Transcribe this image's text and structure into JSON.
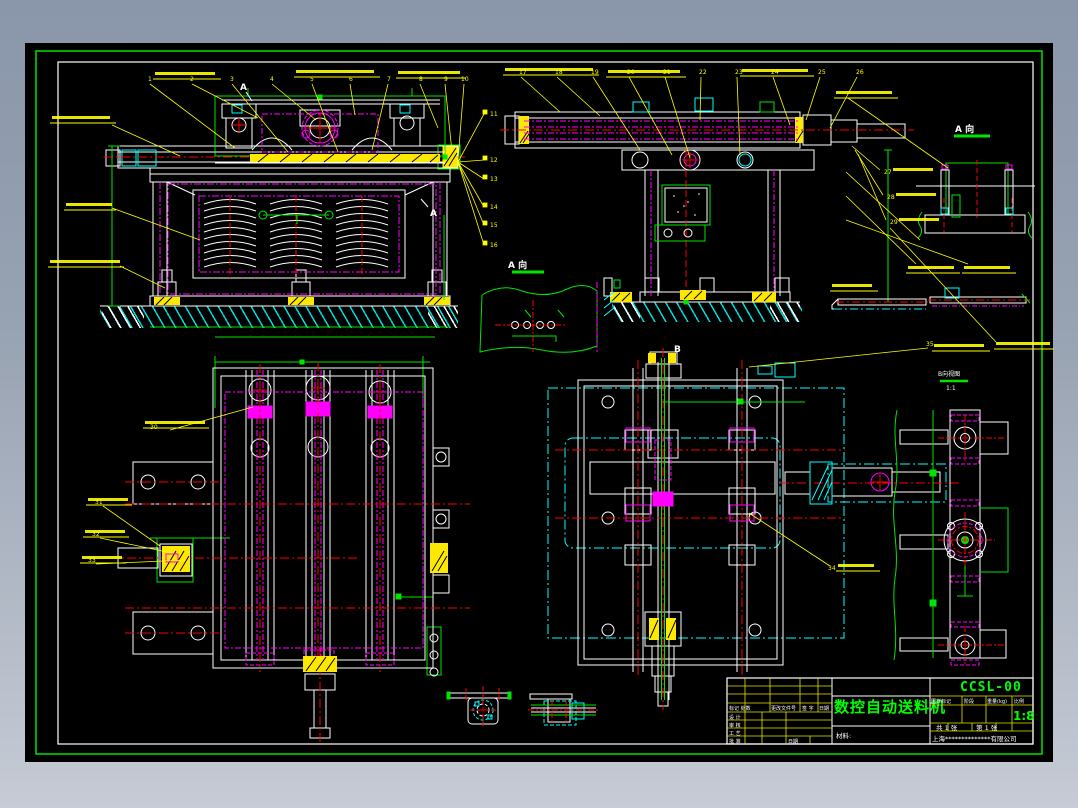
{
  "drawing": {
    "type": "CAD assembly drawing",
    "background": "#000000",
    "frame_gray_top": "#8a96aa",
    "frame_gray_bottom": "#c6cbd5",
    "border_green": "#00e400",
    "sheet_border_white": "#ffffff"
  },
  "colors": {
    "outline": "#ffffff",
    "centerline_red": "#ff0000",
    "phantom_magenta": "#ff00ff",
    "phantom_cyan": "#00ffff",
    "dimension_green": "#00e400",
    "annotation_yellow": "#ffff00"
  },
  "title_block": {
    "product_name": "数控自动送料机",
    "drawing_no": "CCSL-00",
    "scale": "1:8",
    "material_label": "材料:",
    "company": "上海**************有限公司",
    "stamp_header": [
      "图样标记",
      "阶段",
      "重量(kg)",
      "比例"
    ],
    "sheet_total": "共 1 张",
    "sheet_no": "第 1 张",
    "revision_header": [
      "标记 处数",
      "更改文件号",
      "签 字",
      "日期"
    ],
    "row_labels": [
      "设 计",
      "审 核",
      "工 艺",
      "批 准"
    ],
    "date_label": "日期"
  },
  "view_labels": {
    "a_view_mid": "A 向",
    "a_view_right": "A 向",
    "b_view": "B向视图",
    "b_view_scale": "1:1",
    "section_mark_a1": "A",
    "section_mark_a2": "A",
    "section_mark_b": "B"
  },
  "callouts": [
    "1",
    "2",
    "3",
    "4",
    "5",
    "6",
    "7",
    "8",
    "9",
    "10",
    "11",
    "12",
    "13",
    "14",
    "15",
    "16",
    "17",
    "18",
    "19",
    "20",
    "21",
    "22",
    "23",
    "24",
    "25",
    "26",
    "27",
    "28",
    "29",
    "30",
    "31",
    "32",
    "33",
    "34",
    "35"
  ]
}
